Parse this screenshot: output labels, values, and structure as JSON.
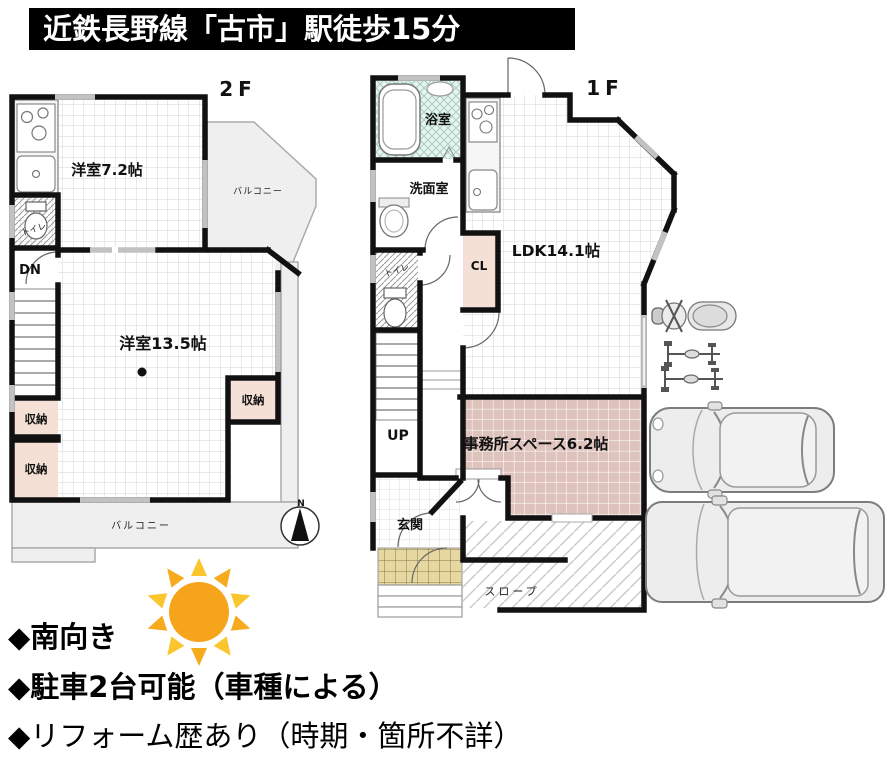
{
  "header": {
    "title": "近鉄長野線「古市」駅徒歩15分"
  },
  "floor2": {
    "label": "2F",
    "rooms": {
      "western_7_2": "洋室7.2帖",
      "balcony_side": "バルコニー",
      "toilet": "トイレ",
      "stairs_down": "DN",
      "western_13_5": "洋室13.5帖",
      "storage_left_upper": "収納",
      "storage_left_lower": "収納",
      "storage_right": "収納",
      "balcony_bottom": "バルコニー"
    }
  },
  "floor1": {
    "label": "1F",
    "rooms": {
      "bath": "浴室",
      "washroom": "洗面室",
      "toilet": "トイレ",
      "closet": "CL",
      "ldk": "LDK14.1帖",
      "stairs_up": "UP",
      "office": "事務所スペース6.2帖",
      "entrance": "玄関",
      "slope": "スロープ"
    }
  },
  "compass": {
    "north_label": "N"
  },
  "features": {
    "items": [
      {
        "text": "◆南向き"
      },
      {
        "text": "◆駐車2台可能（車種による）"
      },
      {
        "text": "◆リフォーム歴あり（時期・箇所不詳）"
      }
    ]
  },
  "colors": {
    "wall": "#111111",
    "storage_fill": "#f4e0d4",
    "office_fill": "#dec3bd",
    "bath_fill": "#e8f4ef",
    "porch_fill": "#e7d7a0",
    "balcony_fill": "#efefef",
    "sun_core": "#F5A41C",
    "sun_ray": "#FBC52D"
  }
}
